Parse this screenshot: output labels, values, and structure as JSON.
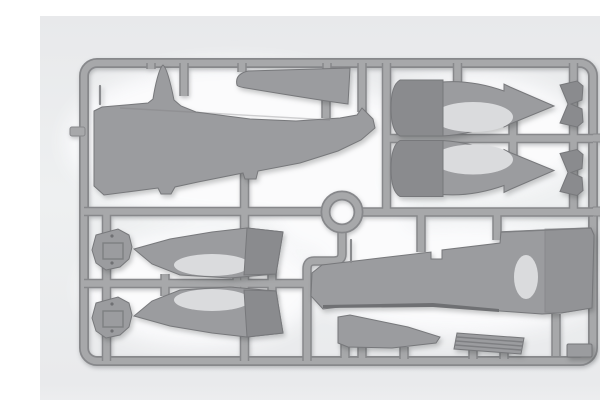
{
  "meta": {
    "alt": "Backlit photograph of a gray plastic model aircraft kit sprue (parts frame)",
    "scene": "injection-molded sprue with aircraft parts held in a rounded rectangular runner frame",
    "part_count_visible": 16
  },
  "colors": {
    "bg_top": "#e8e9eb",
    "bg_mid": "#eef0f1",
    "bg_bottom": "#e9eaec",
    "bg_edge": "#f0f1f2",
    "glow": "#fdfdfe",
    "runner_core": "#a7a8aa",
    "runner_edge": "#87888b",
    "plastic": "#9b9c9f",
    "plastic_dark": "#8a8b8e",
    "plastic_edge": "#77787b",
    "interior": "#dadbdd",
    "band": "#6f7073",
    "detail": "#7e7f82"
  },
  "parts": [
    {
      "id": "fuselage-half-large",
      "zone": "top-left",
      "note": "long half with tall fin spike and pointed nose"
    },
    {
      "id": "horizontal-stabilizer",
      "zone": "top-center"
    },
    {
      "id": "nacelle-half-upper-right-1",
      "zone": "top-right",
      "note": "dark cowl ring, arrow-shaped tail"
    },
    {
      "id": "nacelle-half-upper-right-2",
      "zone": "top-right",
      "note": "mirrored half"
    },
    {
      "id": "cowl-flap-segment-1",
      "zone": "right-top",
      "note": "notched chevron part"
    },
    {
      "id": "cowl-flap-segment-2",
      "zone": "right-top",
      "note": "notched chevron part"
    },
    {
      "id": "nacelle-half-lower-left-1",
      "zone": "middle-left",
      "note": "pointed nose left, dark rear ring"
    },
    {
      "id": "nacelle-half-lower-left-2",
      "zone": "middle-left",
      "note": "mirrored half"
    },
    {
      "id": "engine-bulkhead-1",
      "zone": "left",
      "note": "round firewall disc with recess"
    },
    {
      "id": "engine-bulkhead-2",
      "zone": "left",
      "note": "round firewall disc with recess"
    },
    {
      "id": "lower-wing-panel",
      "zone": "bottom-right",
      "note": "tapered panel with notch, step and oval wheel-well opening"
    },
    {
      "id": "wing-fillet-wedge",
      "zone": "bottom-center"
    },
    {
      "id": "radiator-ribbed-plate",
      "zone": "bottom-center",
      "note": "parallelogram with ridge lines"
    },
    {
      "id": "small-rect-part",
      "zone": "bottom-right-corner"
    },
    {
      "id": "antenna-pin",
      "zone": "top-left",
      "note": "thin pin beside fuselage edge"
    },
    {
      "id": "pitot-stick",
      "zone": "center",
      "note": "thin stick above lower wing panel"
    }
  ],
  "sprue": {
    "frame_shape": "rounded rectangle",
    "center_feature": "circular runner ring",
    "material": "gray styrene"
  }
}
